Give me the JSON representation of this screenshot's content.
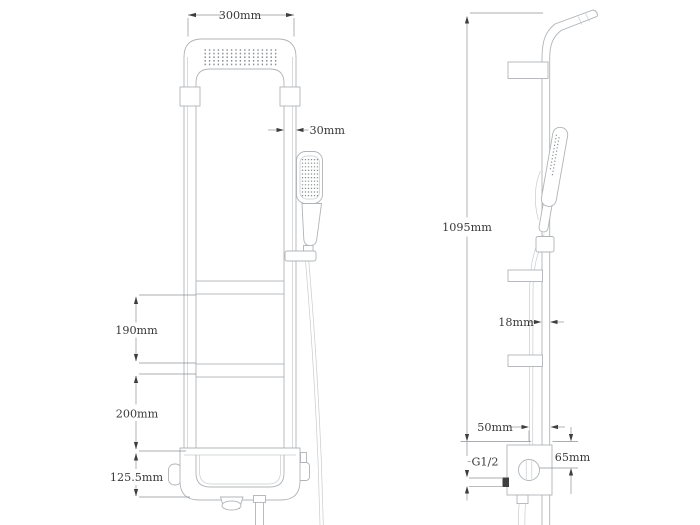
{
  "drawing": {
    "title": "shower-panel-technical-drawing",
    "views": {
      "left": "front view",
      "right": "side view"
    },
    "labels": {
      "panel_width": "300mm",
      "rail_width": "30mm",
      "shelf_spacing": "190mm",
      "lower_spacing": "200mm",
      "tank_height": "125.5mm",
      "total_height": "1095mm",
      "rail_depth": "18mm",
      "valve_offset": "50mm",
      "inlet_thread": "G1/2",
      "valve_drop": "65mm"
    },
    "colors": {
      "background": "#ffffff",
      "outline": "#b0b4b8",
      "light_line": "#c8cbce",
      "dimension_line": "#8f9296",
      "arrow": "#3f3f3f",
      "text": "#3a3a3a"
    }
  }
}
